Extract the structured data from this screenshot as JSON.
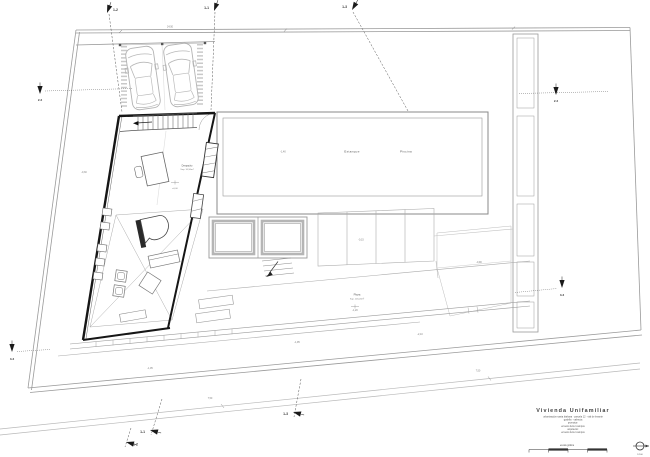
{
  "plan": {
    "rooms": {
      "pond_label": "Estanque",
      "pool_label": "Piscina",
      "pool_depth": "-1,40",
      "office_label": "Despacho",
      "office_area": "Sup. 10,50m²",
      "office_level": "±0,00",
      "plaza_label": "Plaza",
      "plaza_area": "Sup. 145,20m²",
      "plaza_level": "-1,20",
      "deck_level": "-0,15",
      "lawn_level": "-0,90",
      "garden_level": "-0,30",
      "terrace_level_1": "-1,05",
      "terrace_level_2": "-1,95",
      "terrace_level_3": "-2,10",
      "top_dim": "24,50",
      "street_dim_1": "7,50",
      "street_dim_2": "7,50"
    },
    "sections": {
      "top_left": "1-2",
      "top_mid": "1-1",
      "top_right": "1-3",
      "bottom_left": "1-2",
      "bottom_mid": "1-1",
      "bottom_right": "1-3",
      "west": "2-2",
      "east": "2-2",
      "diag_left": "3-3",
      "diag_right": "3-3"
    },
    "title_block": {
      "project_title": "Vivienda Unifamiliar",
      "line_1": "urbanización santa bárbara · parcela 12 · vial de levante",
      "line_2": "godella · valencia",
      "line_3": "promotor:",
      "line_4": "ernesto ferrer campos",
      "line_5": "arquitecto:",
      "line_6": "ernesto ferrer campos",
      "scale_caption": "escala gráfica",
      "north_note": "1/100"
    }
  }
}
